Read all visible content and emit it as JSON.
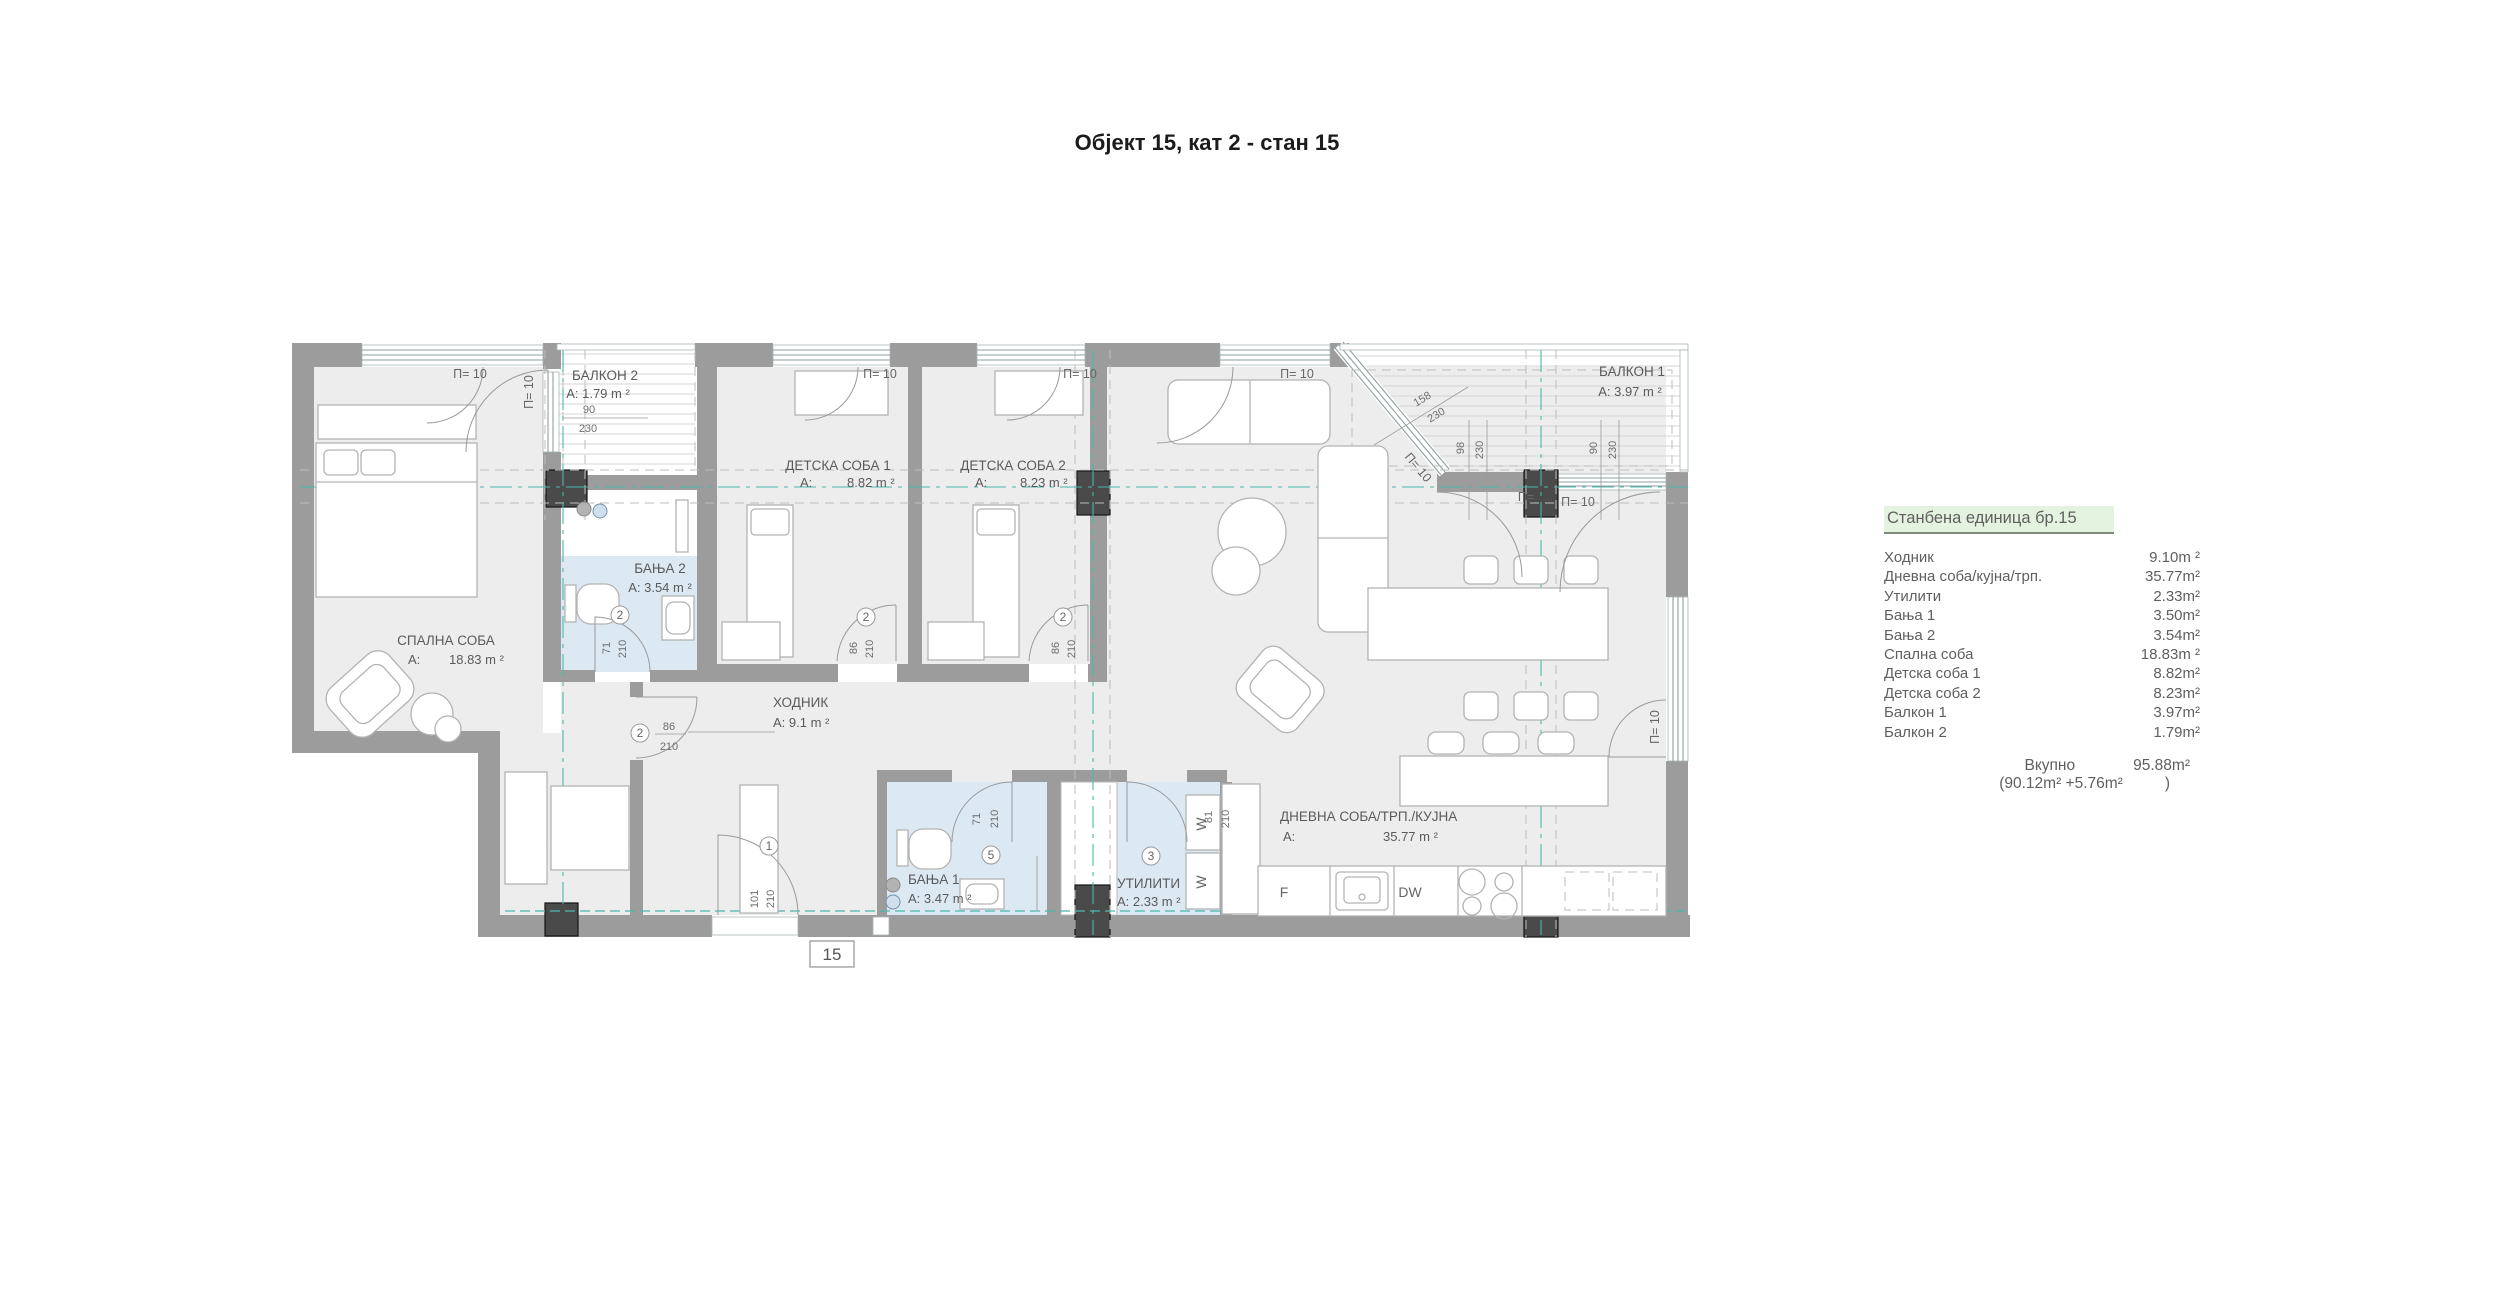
{
  "title": "Објект 15, кат 2 - стан 15",
  "legend": {
    "header": "Станбена единица бр.15",
    "rows": [
      {
        "label": "Ходник",
        "value": "9.10m ²"
      },
      {
        "label": "Дневна соба/кујна/трп.",
        "value": "35.77m²"
      },
      {
        "label": "Утилити",
        "value": "2.33m²"
      },
      {
        "label": "Бања 1",
        "value": "3.50m²"
      },
      {
        "label": "Бања 2",
        "value": "3.54m²"
      },
      {
        "label": "Спална соба",
        "value": "18.83m ²"
      },
      {
        "label": "Детска соба 1",
        "value": "8.82m²"
      },
      {
        "label": "Детска соба 2",
        "value": "8.23m²"
      },
      {
        "label": "Балкон 1",
        "value": "3.97m²"
      },
      {
        "label": "Балкон 2",
        "value": "1.79m²"
      }
    ],
    "total_label": "Вкупно",
    "total_value": "95.88m²",
    "total_breakdown": "(90.12m² +5.76m²",
    "total_breakdown_close": ")"
  },
  "plan": {
    "unit_badge": "15",
    "window_label": "П= 10",
    "window_label_short": "П=",
    "rooms": {
      "bedroom": {
        "name": "СПАЛНА СОБА",
        "a": "A:",
        "v": "18.83 m ²"
      },
      "living": {
        "name": "ДНЕВНА СОБА/ТРП./КУЈНА",
        "a": "A:",
        "v": "35.77 m ²"
      },
      "hodnik": {
        "name": "ХОДНИК",
        "area": "A: 9.1 m ²"
      },
      "banja1": {
        "name": "БАЊА 1",
        "area": "A: 3.47 m ²"
      },
      "banja2": {
        "name": "БАЊА 2",
        "area": "A: 3.54 m ²"
      },
      "utility": {
        "name": "УТИЛИТИ",
        "area": "A: 2.33 m ²"
      },
      "detska1": {
        "name": "ДЕТСКА СОБА 1",
        "a": "A:",
        "v": "8.82 m ²"
      },
      "detska2": {
        "name": "ДЕТСКА СОБА 2",
        "a": "A:",
        "v": "8.23 m ²"
      },
      "balcony1": {
        "name": "БАЛКОН 1",
        "area": "A:  3.97 m ²"
      },
      "balcony2": {
        "name": "БАЛКОН 2",
        "area": "A:  1.79 m ²",
        "dim_w": "90",
        "dim_h": "230"
      }
    },
    "doors": {
      "n1": "1",
      "n2": "2",
      "n3": "3",
      "n5": "5"
    },
    "dims": {
      "d71": "71",
      "d81": "81",
      "d86": "86",
      "d90": "90",
      "d98": "98",
      "d101": "101",
      "d158": "158",
      "d210": "210",
      "d230": "230"
    },
    "kitchen": {
      "fridge": "F",
      "dishwasher": "DW",
      "washer": "W"
    },
    "colors": {
      "wall": "#9c9c9c",
      "column": "#4a4a4a",
      "room_fill": "#ededed",
      "bath_fill": "#dce8f2",
      "axis_teal": "#49b8ab",
      "legend_bg": "#e4f3e0",
      "text": "#5a5a5a"
    }
  }
}
